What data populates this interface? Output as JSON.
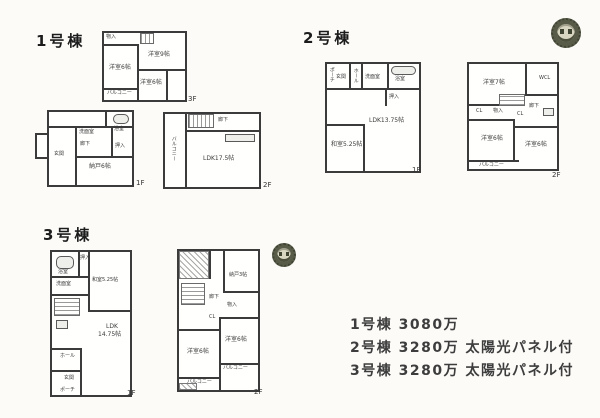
{
  "sheet": {
    "background": "#fcfbf8",
    "wall_color": "#3b3b3b",
    "stamp_color": "#575b48"
  },
  "b1": {
    "name": "1号棟",
    "f1": {
      "tag": "1F",
      "genkan": "玄関",
      "rouka": "廊下",
      "senmen": "洗面室",
      "yokushitsu": "浴室",
      "oshiire": "押入",
      "nando": "納戸6帖"
    },
    "f2": {
      "tag": "2F",
      "ldk": "LDK17.5帖",
      "rouka": "廊下",
      "balcony": "バルコニー"
    },
    "f3": {
      "tag": "3F",
      "monoire": "物入",
      "yoshitsu_left": "洋室6帖",
      "yoshitsu_right": "洋室9帖",
      "yoshitsu_mid": "洋室6帖",
      "balcony": "バルコニー"
    }
  },
  "b2": {
    "name": "2号棟",
    "f1": {
      "tag": "1F",
      "porch": "ポーチ",
      "genkan": "玄関",
      "hall": "ホール",
      "senmen": "洗面室",
      "yokushitsu": "浴室",
      "oshiire": "押入",
      "ldk": "LDK13.75帖",
      "washitsu": "和室5.25帖"
    },
    "f2": {
      "tag": "2F",
      "yoshitsu7": "洋室7帖",
      "wcl": "WCL",
      "cl1": "CL",
      "monoire": "物入",
      "rouka": "廊下",
      "cl2": "CL",
      "yoshitsu6a": "洋室6帖",
      "yoshitsu6b": "洋室6帖",
      "balcony": "バルコニー"
    }
  },
  "b3": {
    "name": "3号棟",
    "f1": {
      "tag": "1F",
      "yokushitsu": "浴室",
      "oshiire": "押入",
      "washitsu": "和室5.25帖",
      "senmen": "洗面室",
      "ldk_line1": "LDK",
      "ldk_line2": "14.75帖",
      "hall": "ホール",
      "genkan": "玄関",
      "porch": "ポーチ"
    },
    "f2": {
      "tag": "2F",
      "nando": "納戸3帖",
      "rouka": "廊下",
      "monoire": "物入",
      "cl": "CL",
      "yoshitsu6a": "洋室6帖",
      "yoshitsu6b": "洋室6帖",
      "balcony_right": "バルコニー",
      "balcony_bottom": "バルコニー"
    }
  },
  "prices": {
    "line1": "1号棟 3080万",
    "line2": "2号棟 3280万 太陽光パネル付",
    "line3": "3号棟 3280万 太陽光パネル付"
  }
}
